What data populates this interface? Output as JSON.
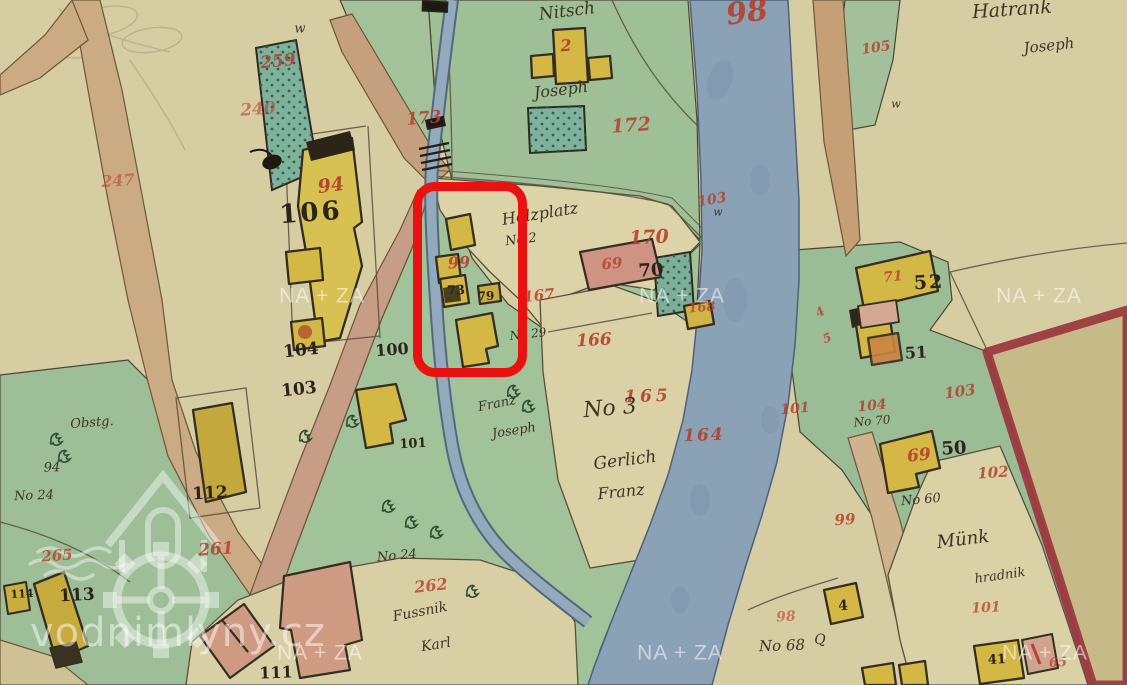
{
  "map": {
    "watermark_text": "NA + ZA",
    "watermark_site": "vodnimlyny.cz",
    "highlight": {
      "x": 413,
      "y": 182,
      "w": 114,
      "h": 195,
      "color": "#ea1111"
    },
    "colors": {
      "parchment": "#d7cda3",
      "meadow": "#a2c29a",
      "river": "#8ba1b6",
      "road": "#cbab83",
      "building_wood": "#d3b845",
      "building_masonry": "#cf9a82",
      "garden": "#7fb29d",
      "red_number": "#b5402c",
      "black_number": "#2b2418",
      "plot_border": "#9c3a3e",
      "highlight": "#ea1111"
    },
    "watermark_positions": [
      [
        322,
        296
      ],
      [
        682,
        296
      ],
      [
        1039,
        296
      ],
      [
        320,
        653
      ],
      [
        680,
        653
      ],
      [
        1045,
        653
      ]
    ],
    "labels": [
      {
        "t": "247",
        "x": 118,
        "y": 181,
        "c": "red",
        "s": 16,
        "r": -4,
        "o": 0.55
      },
      {
        "t": "259",
        "x": 278,
        "y": 62,
        "c": "red",
        "s": 17,
        "r": -6,
        "o": 0.9
      },
      {
        "t": "240",
        "x": 258,
        "y": 110,
        "c": "red",
        "s": 17,
        "r": -4,
        "o": 0.6
      },
      {
        "t": "94",
        "x": 331,
        "y": 186,
        "c": "red",
        "s": 19,
        "r": -8,
        "o": 0.95
      },
      {
        "t": "173",
        "x": 424,
        "y": 119,
        "c": "red",
        "s": 17,
        "r": -5,
        "o": 0.85
      },
      {
        "t": "2",
        "x": 566,
        "y": 46,
        "c": "red",
        "s": 16,
        "r": -4,
        "o": 0.95
      },
      {
        "t": "172",
        "x": 631,
        "y": 126,
        "c": "red",
        "s": 19,
        "r": -4,
        "o": 0.85
      },
      {
        "t": "105",
        "x": 876,
        "y": 48,
        "c": "red",
        "s": 14,
        "r": -8,
        "o": 0.85
      },
      {
        "t": "98",
        "x": 747,
        "y": 13,
        "c": "red",
        "s": 30,
        "r": -8,
        "o": 0.9
      },
      {
        "t": "99",
        "x": 459,
        "y": 263,
        "c": "red",
        "s": 16,
        "r": -3,
        "o": 0.9
      },
      {
        "t": "170",
        "x": 649,
        "y": 238,
        "c": "red",
        "s": 19,
        "r": -3,
        "o": 0.9
      },
      {
        "t": "103",
        "x": 712,
        "y": 200,
        "c": "red",
        "s": 14,
        "r": -10,
        "o": 0.85
      },
      {
        "t": "69",
        "x": 612,
        "y": 264,
        "c": "red",
        "s": 15,
        "r": -5,
        "o": 0.8
      },
      {
        "t": "167",
        "x": 539,
        "y": 296,
        "c": "red",
        "s": 15,
        "r": -6,
        "o": 0.85
      },
      {
        "t": "166",
        "x": 594,
        "y": 341,
        "c": "red",
        "s": 17,
        "r": -3,
        "o": 0.9
      },
      {
        "t": "165",
        "x": 648,
        "y": 397,
        "c": "red",
        "s": 17,
        "r": -2,
        "o": 0.9,
        "ls": 4
      },
      {
        "t": "164",
        "x": 704,
        "y": 436,
        "c": "red",
        "s": 17,
        "r": -2,
        "o": 0.9,
        "ls": 2
      },
      {
        "t": "168",
        "x": 702,
        "y": 308,
        "c": "red",
        "s": 13,
        "r": -5,
        "o": 0.8
      },
      {
        "t": "101",
        "x": 795,
        "y": 409,
        "c": "red",
        "s": 14,
        "r": -5,
        "o": 0.85
      },
      {
        "t": "104",
        "x": 872,
        "y": 406,
        "c": "red",
        "s": 14,
        "r": -6,
        "o": 0.85
      },
      {
        "t": "103",
        "x": 960,
        "y": 392,
        "c": "red",
        "s": 15,
        "r": -8,
        "o": 0.85
      },
      {
        "t": "102",
        "x": 993,
        "y": 473,
        "c": "red",
        "s": 15,
        "r": -4,
        "o": 0.85
      },
      {
        "t": "69",
        "x": 919,
        "y": 456,
        "c": "red",
        "s": 17,
        "r": -6,
        "o": 0.9
      },
      {
        "t": "71",
        "x": 893,
        "y": 277,
        "c": "red",
        "s": 14,
        "r": -5,
        "o": 0.8
      },
      {
        "t": "99",
        "x": 845,
        "y": 520,
        "c": "red",
        "s": 15,
        "r": -4,
        "o": 0.85
      },
      {
        "t": "98",
        "x": 786,
        "y": 617,
        "c": "red",
        "s": 14,
        "r": -4,
        "o": 0.6
      },
      {
        "t": "261",
        "x": 216,
        "y": 550,
        "c": "red",
        "s": 17,
        "r": -4,
        "o": 0.85
      },
      {
        "t": "265",
        "x": 57,
        "y": 556,
        "c": "red",
        "s": 15,
        "r": -4,
        "o": 0.8
      },
      {
        "t": "262",
        "x": 431,
        "y": 586,
        "c": "red",
        "s": 16,
        "r": -6,
        "o": 0.8
      },
      {
        "t": "101",
        "x": 986,
        "y": 608,
        "c": "red",
        "s": 14,
        "r": -3,
        "o": 0.75
      },
      {
        "t": "65",
        "x": 1058,
        "y": 663,
        "c": "red",
        "s": 13,
        "r": -4,
        "o": 0.75
      },
      {
        "t": "4",
        "x": 820,
        "y": 312,
        "c": "red",
        "s": 12,
        "r": -30,
        "o": 0.8
      },
      {
        "t": "5",
        "x": 827,
        "y": 338,
        "c": "red",
        "s": 12,
        "r": -20,
        "o": 0.8
      },
      {
        "t": "106",
        "x": 311,
        "y": 213,
        "c": "black",
        "s": 26,
        "r": -4,
        "ls": 3
      },
      {
        "t": "104",
        "x": 301,
        "y": 351,
        "c": "black",
        "s": 17,
        "r": -6
      },
      {
        "t": "103",
        "x": 299,
        "y": 390,
        "c": "black",
        "s": 17,
        "r": -6
      },
      {
        "t": "100",
        "x": 392,
        "y": 350,
        "c": "black",
        "s": 16,
        "r": -4
      },
      {
        "t": "101",
        "x": 413,
        "y": 444,
        "c": "black",
        "s": 13,
        "r": -3
      },
      {
        "t": "73",
        "x": 456,
        "y": 291,
        "c": "black",
        "s": 13,
        "r": -3
      },
      {
        "t": "79",
        "x": 486,
        "y": 296,
        "c": "black",
        "s": 12,
        "r": -3
      },
      {
        "t": "70",
        "x": 651,
        "y": 271,
        "c": "black",
        "s": 18,
        "r": -3
      },
      {
        "t": "112",
        "x": 210,
        "y": 494,
        "c": "black",
        "s": 17,
        "r": -3
      },
      {
        "t": "113",
        "x": 77,
        "y": 596,
        "c": "black",
        "s": 17,
        "r": -3
      },
      {
        "t": "114",
        "x": 22,
        "y": 594,
        "c": "black",
        "s": 11,
        "r": -3
      },
      {
        "t": "111",
        "x": 276,
        "y": 673,
        "c": "black",
        "s": 16,
        "r": -2
      },
      {
        "t": "52",
        "x": 929,
        "y": 283,
        "c": "black",
        "s": 19,
        "r": -3,
        "ls": 2
      },
      {
        "t": "51",
        "x": 916,
        "y": 353,
        "c": "black",
        "s": 16,
        "r": -3
      },
      {
        "t": "50",
        "x": 954,
        "y": 449,
        "c": "black",
        "s": 18,
        "r": -3
      },
      {
        "t": "4",
        "x": 843,
        "y": 606,
        "c": "black",
        "s": 14,
        "r": -3
      },
      {
        "t": "41",
        "x": 997,
        "y": 660,
        "c": "black",
        "s": 13,
        "r": -3
      },
      {
        "t": "Nitsch",
        "x": 567,
        "y": 12,
        "c": "hand",
        "s": 17,
        "r": -7
      },
      {
        "t": "Joseph",
        "x": 561,
        "y": 90,
        "c": "hand",
        "s": 16,
        "r": -7
      },
      {
        "t": "Hatrank",
        "x": 1012,
        "y": 10,
        "c": "hand",
        "s": 19,
        "r": -4
      },
      {
        "t": "Joseph",
        "x": 1049,
        "y": 46,
        "c": "hand",
        "s": 15,
        "r": -6
      },
      {
        "t": "Holzplatz",
        "x": 540,
        "y": 214,
        "c": "hand",
        "s": 16,
        "r": -9
      },
      {
        "t": "No 2",
        "x": 521,
        "y": 240,
        "c": "hand",
        "s": 13,
        "r": -7
      },
      {
        "t": "No 29",
        "x": 528,
        "y": 334,
        "c": "hand",
        "s": 12,
        "r": -6
      },
      {
        "t": "Franz",
        "x": 497,
        "y": 404,
        "c": "hand",
        "s": 13,
        "r": -11
      },
      {
        "t": "Joseph",
        "x": 514,
        "y": 431,
        "c": "hand",
        "s": 13,
        "r": -9
      },
      {
        "t": "No 3",
        "x": 610,
        "y": 409,
        "c": "hand",
        "s": 22,
        "r": -5
      },
      {
        "t": "Gerlich",
        "x": 625,
        "y": 461,
        "c": "hand",
        "s": 17,
        "r": -7
      },
      {
        "t": "Franz",
        "x": 621,
        "y": 492,
        "c": "hand",
        "s": 16,
        "r": -6
      },
      {
        "t": "No 24",
        "x": 34,
        "y": 496,
        "c": "hand",
        "s": 13,
        "r": -2
      },
      {
        "t": "94",
        "x": 52,
        "y": 468,
        "c": "hand",
        "s": 13,
        "r": -2
      },
      {
        "t": "Obstg.",
        "x": 92,
        "y": 423,
        "c": "hand",
        "s": 13,
        "r": -4
      },
      {
        "t": "No 24",
        "x": 397,
        "y": 556,
        "c": "hand",
        "s": 13,
        "r": -5
      },
      {
        "t": "Fussnik",
        "x": 420,
        "y": 612,
        "c": "hand",
        "s": 14,
        "r": -11
      },
      {
        "t": "Karl",
        "x": 436,
        "y": 645,
        "c": "hand",
        "s": 14,
        "r": -9
      },
      {
        "t": "No 68",
        "x": 782,
        "y": 646,
        "c": "hand",
        "s": 15,
        "r": -2
      },
      {
        "t": "Q",
        "x": 820,
        "y": 640,
        "c": "hand",
        "s": 14,
        "r": -3
      },
      {
        "t": "Münk",
        "x": 963,
        "y": 540,
        "c": "hand",
        "s": 18,
        "r": -7
      },
      {
        "t": "hradnik",
        "x": 1000,
        "y": 576,
        "c": "hand",
        "s": 13,
        "r": -8
      },
      {
        "t": "No 60",
        "x": 921,
        "y": 500,
        "c": "hand",
        "s": 13,
        "r": -5
      },
      {
        "t": "No 70",
        "x": 872,
        "y": 421,
        "c": "hand",
        "s": 12,
        "r": -5
      },
      {
        "t": "w",
        "x": 300,
        "y": 29,
        "c": "hand",
        "s": 13,
        "r": 0
      },
      {
        "t": "w",
        "x": 718,
        "y": 212,
        "c": "hand",
        "s": 11,
        "r": 0
      },
      {
        "t": "w",
        "x": 896,
        "y": 104,
        "c": "hand",
        "s": 11,
        "r": 0
      }
    ]
  }
}
